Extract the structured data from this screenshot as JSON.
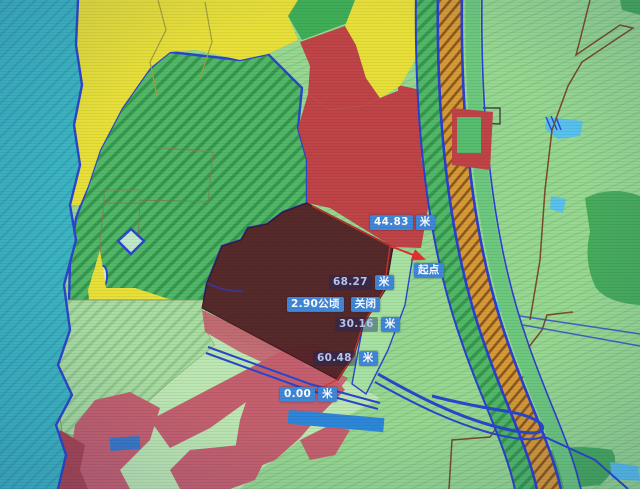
{
  "app": {
    "title": "land-parcel-map-view"
  },
  "map_labels": {
    "measurements": [
      {
        "value": "44.83",
        "unit": "米",
        "style": "solid"
      },
      {
        "value": "68.27",
        "unit": "米",
        "style": "dim"
      },
      {
        "value": "30.16",
        "unit": "米",
        "style": "dim"
      },
      {
        "value": "60.48",
        "unit": "米",
        "style": "dim"
      },
      {
        "value": "0.00",
        "unit": "米",
        "style": "solid"
      }
    ],
    "area": {
      "value": "2.90公顷",
      "close_button": "关闭"
    },
    "start_point": "起点"
  },
  "colors": {
    "label_background": "#3f87d9",
    "selected_parcel": "#542428",
    "measure_line_red": "#e2312e",
    "water_teal": "#3db7c4",
    "forest_green": "#52b868",
    "farmland_yellow": "#e8e039",
    "construction_red": "#bf4448",
    "road_corridor_orange": "#d89a35",
    "boundary_blue": "#2b46cc",
    "background_mint": "#98d892"
  }
}
